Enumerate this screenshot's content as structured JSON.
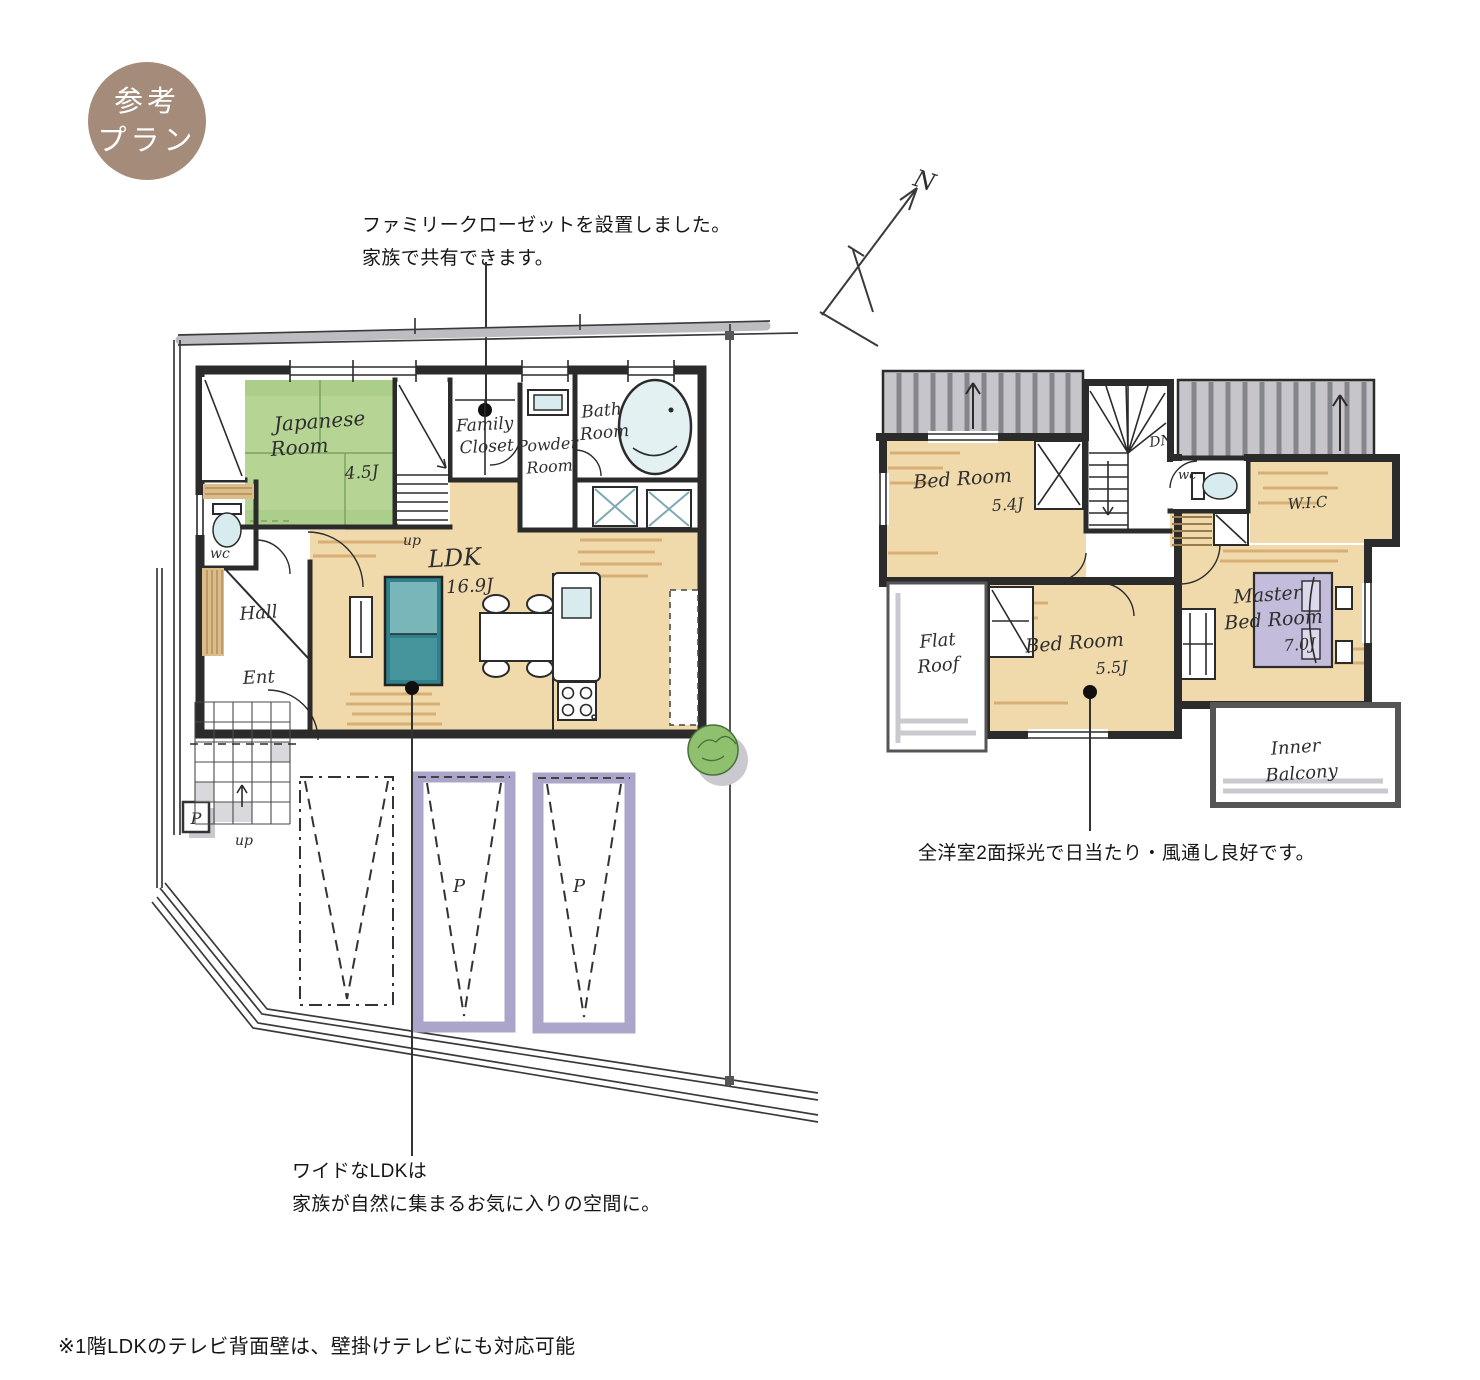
{
  "badge": {
    "line1": "参考",
    "line2": "プラン"
  },
  "annotations": {
    "family_closet_1": "ファミリークローゼットを設置しました。",
    "family_closet_2": "家族で共有できます。",
    "ldk_1": "ワイドなLDKは",
    "ldk_2": "家族が自然に集まるお気に入りの空間に。",
    "daylight": "全洋室2面採光で日当たり・風通し良好です。",
    "footnote": "※1階LDKのテレビ背面壁は、壁掛けテレビにも対応可能"
  },
  "compass": {
    "label": "N"
  },
  "floor1": {
    "japanese_room": {
      "name1": "Japanese",
      "name2": "Room",
      "size": "4.5J"
    },
    "family_closet": {
      "name1": "Family",
      "name2": "Closet"
    },
    "powder_room": {
      "name1": "Powder",
      "name2": "Room"
    },
    "bath_room": {
      "name1": "Bath",
      "name2": "Room"
    },
    "wc": "wc",
    "hall": "Hall",
    "ent": "Ent",
    "ldk": {
      "name": "LDK",
      "size": "16.9J"
    },
    "stairs_up": "up",
    "porch_up": "up",
    "parking_sign": "P",
    "parking_stall_1": "P",
    "parking_stall_2": "P"
  },
  "floor2": {
    "bed_room_a": {
      "name": "Bed Room",
      "size": "5.4J"
    },
    "bed_room_b": {
      "name": "Bed Room",
      "size": "5.5J"
    },
    "master_bed_room": {
      "name1": "Master",
      "name2": "Bed Room",
      "size": "7.0J"
    },
    "wc": "wc",
    "wic": "W.I.C",
    "stairs_dn": "DN",
    "flat_roof": {
      "name1": "Flat",
      "name2": "Roof"
    },
    "inner_balcony": {
      "name1": "Inner",
      "name2": "Balcony"
    }
  },
  "colors": {
    "ink": "#2b2b2b",
    "badge": "#a58c7a",
    "tatami": "#b6d595",
    "tatamiDark": "#7da25e",
    "floor": "#f0d9ab",
    "floorDark": "#cfa063",
    "aqua": "#d8ecef",
    "wood": "#dcbc88",
    "sofa": "#46959d",
    "sofaLight": "#79b6ba",
    "sofaDark": "#2f828c",
    "parking": "#aba6c9",
    "bed": "#c3bddb",
    "bedLight": "#ddd9ec",
    "roof": "#c6c5ca",
    "roofDark": "#85858c",
    "shadow": "#c9c9cf",
    "boundary": "#bcbcc1",
    "tree": "#8ec06e"
  }
}
